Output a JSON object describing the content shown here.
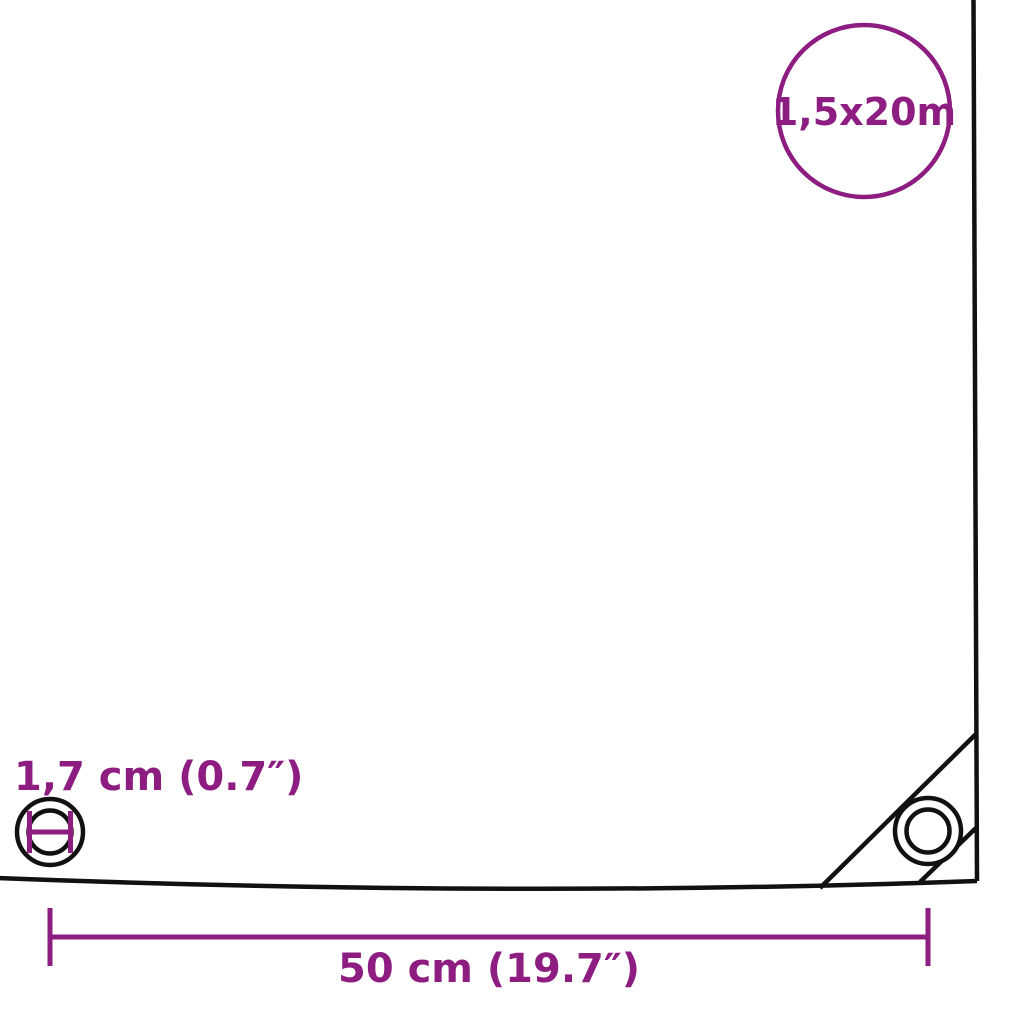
{
  "diagram": {
    "title": "tarpaulin-dimension-diagram",
    "colors": {
      "accent": "#8e1d82",
      "line": "#111111",
      "background": "#ffffff"
    },
    "badge": {
      "size_text": "1,5x20m"
    },
    "labels": {
      "grommet_diameter": "1,7 cm (0.7″)",
      "grommet_spacing": "50 cm (19.7″)"
    },
    "icons": {
      "edge_grommet": "grommet-icon",
      "corner_grommet": "grommet-icon",
      "diameter_marker": "diameter-measure-icon",
      "spacing_dimension": "dimension-line-icon"
    }
  }
}
